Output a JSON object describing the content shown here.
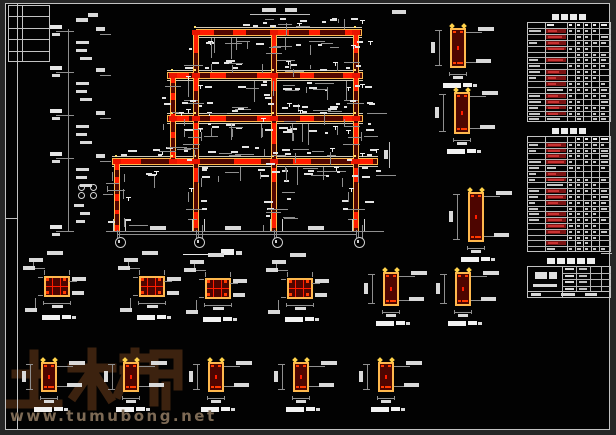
{
  "watermark": {
    "logo_text": "土木帮",
    "url": "www.tumubong.net",
    "logo_color": "#3f2410",
    "url_color": "#7d6a55"
  },
  "palette": {
    "bg": "#020202",
    "outer": "#262626",
    "border": "#c2c2c2",
    "member_edge": "#ffb84d",
    "member_fill": "#520600",
    "segment": "#ff1c00",
    "joint": "#e81400",
    "text_blob": "#d9d9d9",
    "bright_blob": "#f2f2f2",
    "dim": "#8f8f8f",
    "table_red": "#7a1212",
    "table_red_bright": "#c83232"
  },
  "frame": {
    "beams": [
      {
        "x": 196,
        "y": 29,
        "w": 166
      },
      {
        "x": 167,
        "y": 72,
        "w": 196
      },
      {
        "x": 167,
        "y": 115,
        "w": 196
      },
      {
        "x": 112,
        "y": 158,
        "w": 266
      }
    ],
    "beam_h": 7,
    "columns": [
      {
        "x": 114,
        "y1": 162,
        "y2": 232
      },
      {
        "x": 193,
        "y1": 31,
        "y2": 232
      },
      {
        "x": 271,
        "y1": 31,
        "y2": 232
      },
      {
        "x": 353,
        "y1": 31,
        "y2": 232
      },
      {
        "x": 170,
        "y1": 74,
        "y2": 160
      }
    ],
    "col_w": 6,
    "ground": {
      "x": 106,
      "y": 231,
      "w": 278
    },
    "axis_x": [
      117,
      196,
      274,
      356
    ],
    "bubble_y": 241,
    "levels_y": [
      31,
      72,
      115,
      158,
      231
    ],
    "dim_line_y": 234,
    "title_underline": {
      "x": 183,
      "y": 254,
      "w": 36
    }
  },
  "left_strip": {
    "chain_x": 68,
    "chain_y1": 29,
    "chain_y2": 231,
    "tick_x": 56,
    "tick_w": 18,
    "circles": [
      [
        78,
        184
      ],
      [
        78,
        192
      ],
      [
        90,
        184
      ],
      [
        90,
        192
      ]
    ]
  },
  "details": {
    "column_sections": [
      {
        "cx": 57,
        "ty": 276
      },
      {
        "cx": 152,
        "ty": 276
      },
      {
        "cx": 218,
        "ty": 278
      },
      {
        "cx": 300,
        "ty": 278
      }
    ],
    "beam_sections": [
      {
        "cx": 391,
        "ty": 272,
        "h": 34
      },
      {
        "cx": 463,
        "ty": 272,
        "h": 34
      },
      {
        "cx": 49,
        "ty": 362,
        "h": 30
      },
      {
        "cx": 131,
        "ty": 362,
        "h": 30
      },
      {
        "cx": 216,
        "ty": 362,
        "h": 30
      },
      {
        "cx": 301,
        "ty": 362,
        "h": 30
      },
      {
        "cx": 386,
        "ty": 362,
        "h": 30
      },
      {
        "cx": 458,
        "ty": 28,
        "h": 40
      },
      {
        "cx": 462,
        "ty": 92,
        "h": 42
      },
      {
        "cx": 476,
        "ty": 192,
        "h": 50
      }
    ]
  },
  "tables": [
    {
      "x": 527,
      "y": 14,
      "w": 84,
      "rows": 17,
      "row_h": 5.9,
      "cols": [
        18,
        22,
        8,
        8,
        8,
        8,
        12
      ],
      "red_col": 1,
      "red_rows": [
        1,
        2,
        3,
        4,
        6,
        8,
        9,
        10,
        12,
        13,
        14,
        15
      ]
    },
    {
      "x": 527,
      "y": 128,
      "w": 84,
      "rows": 20,
      "row_h": 5.8,
      "cols": [
        18,
        22,
        8,
        8,
        8,
        8,
        12
      ],
      "red_col": 1,
      "red_rows": [
        1,
        2,
        3,
        4,
        6,
        7,
        9,
        10,
        11,
        13,
        14,
        15,
        16,
        18
      ]
    }
  ],
  "title_block": {
    "x": 527,
    "y": 258,
    "w": 84,
    "h": 40,
    "left_cell_w": 35
  },
  "corner_grid": {
    "x": 8,
    "y": 5,
    "w": 42,
    "h": 57,
    "rows": 5,
    "col_split": 14
  },
  "border": {
    "outer": [
      5,
      3,
      605,
      427
    ],
    "margin_x": 17,
    "left_tick_y": 218,
    "right_tick_y": 253
  },
  "misc": {
    "lines": [
      [
        5,
        218,
        12,
        1
      ],
      [
        601,
        253,
        11,
        1
      ],
      [
        389,
        142,
        1,
        26
      ],
      [
        250,
        14,
        60,
        1
      ]
    ],
    "blobs": [
      [
        262,
        8,
        14,
        4
      ],
      [
        285,
        8,
        12,
        4
      ],
      [
        392,
        10,
        14,
        4
      ],
      [
        384,
        150,
        4,
        9
      ],
      [
        74,
        204,
        10,
        3
      ],
      [
        80,
        212,
        10,
        3
      ],
      [
        76,
        220,
        9,
        3
      ],
      [
        76,
        18,
        12,
        4
      ],
      [
        88,
        13,
        10,
        4
      ]
    ]
  }
}
